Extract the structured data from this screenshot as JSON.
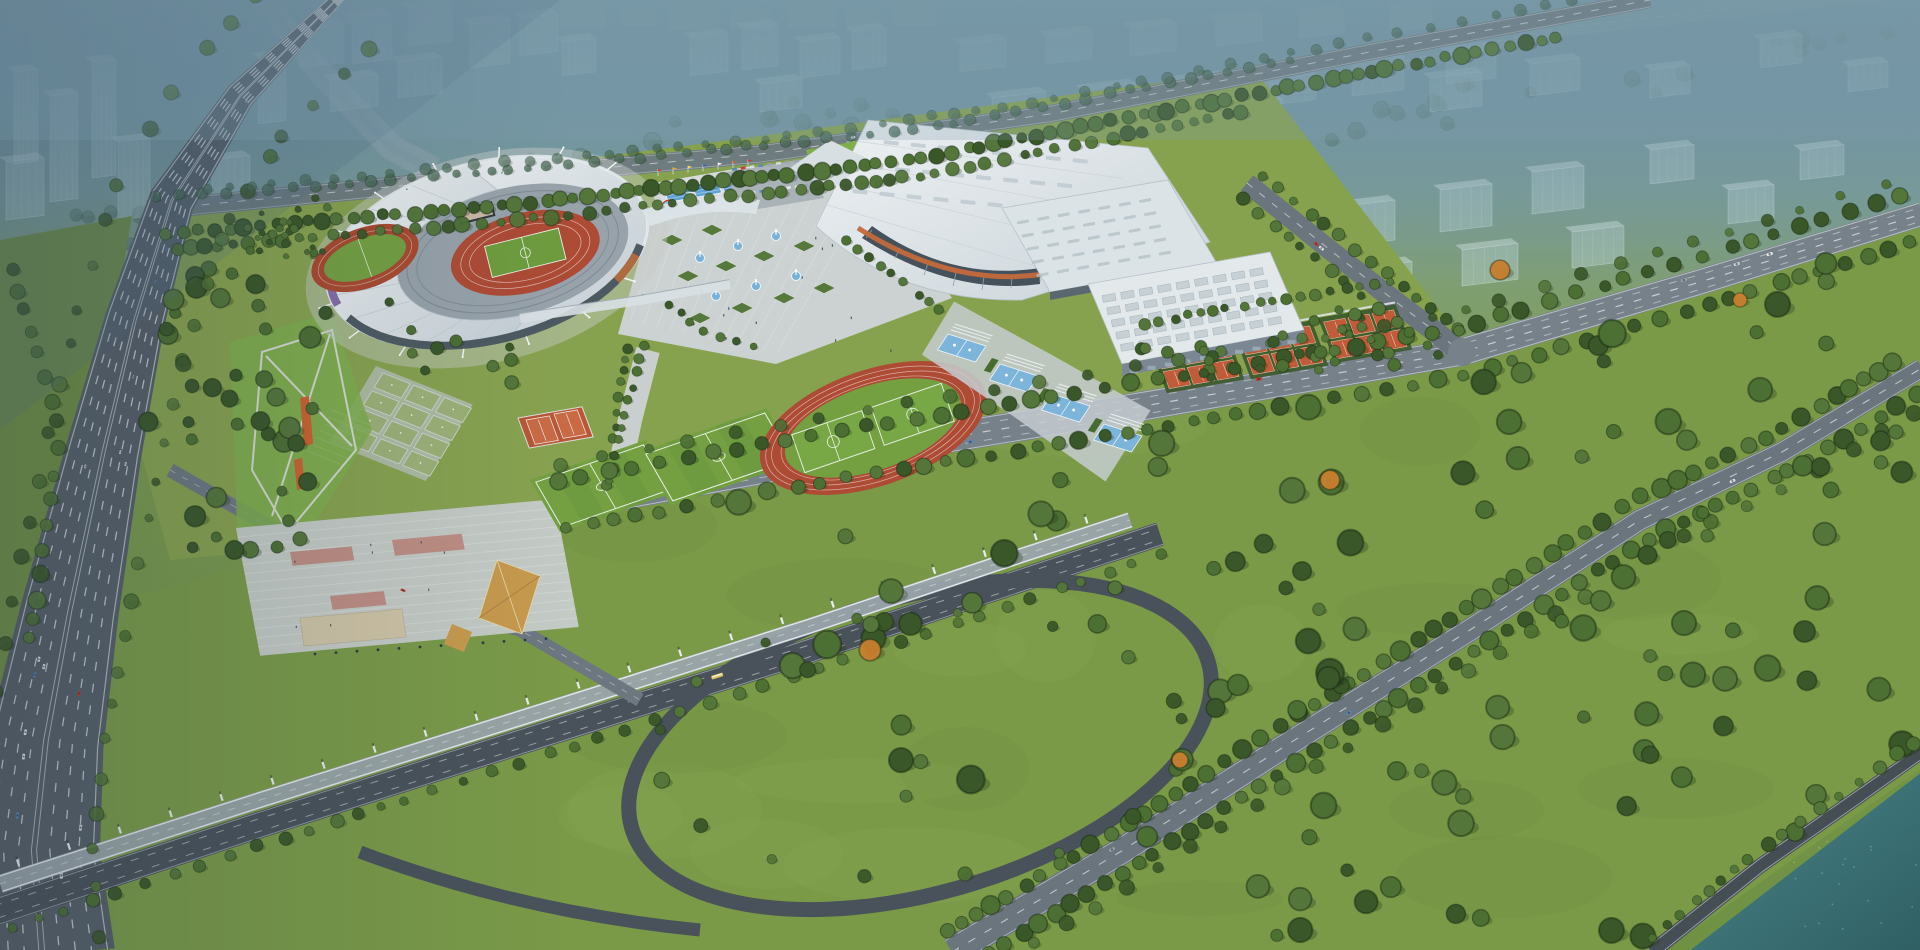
{
  "scene": {
    "description": "Aerial bird's-eye architectural rendering of a large sports-complex masterplan at hazy dusk: main stadium with white ring roof, exhibition arena, sports halls, outdoor courts and fields, central fountain plaza, highways and interchange, wooded riverside park",
    "type": "photorealistic CG aerial rendering"
  },
  "palette": {
    "haze_top": "#5f8494",
    "haze_mid": "#779a94",
    "ground_complex": "#87a24f",
    "ground_park": "#7a9a48",
    "ground_left": "#6f8d45",
    "lawn_bright": "#7fae4c",
    "pitch_green": "#74a042",
    "pitch_green_dark": "#699640",
    "tree_dark": "#3a5729",
    "tree_mid": "#4c6f33",
    "tree_light": "#54763a",
    "tree_far": "#4b6b58",
    "tree_autumn": "#c87f2e",
    "road": "#77818a",
    "road_mid": "#6b757d",
    "road_dark": "#49525a",
    "highway": "#565f68",
    "lane_marking": "#e9eef1",
    "roof_white": "#eef1f3",
    "roof_shadow": "#c3cdd4",
    "glass_dark": "#46525b",
    "facade_purple": "#7b5fa0",
    "facade_orange": "#bf6f3b",
    "track_red": "#ad4b35",
    "clay_court": "#c05c39",
    "clay_light": "#c96a45",
    "court_blue": "#7db4da",
    "pool_blue": "#5fa3d4",
    "plaza_paving": "#ccd2d1",
    "terrace_paving": "#c4cac5",
    "accent_pink": "#bd8277",
    "pavilion_gold": "#c79a4d",
    "beige_building": "#cfc4a6",
    "river": "#3f7478",
    "river_deep": "#2f5f63",
    "ghost_building": "#cfe2e8",
    "stands_grey": "#97a2aa",
    "car_red": "#c23b2e",
    "car_white": "#e8eaec",
    "car_grey": "#9aa5ad",
    "car_blue": "#5a86b8",
    "bus_yellow": "#e0c15a"
  },
  "landmarks": [
    {
      "name": "main-stadium",
      "label": "Main stadium with white ring roof and open bowl"
    },
    {
      "name": "practice-track",
      "label": "Warm-up running track"
    },
    {
      "name": "exhibition-arena",
      "label": "Exhibition arena with arched facade and orange stripe"
    },
    {
      "name": "sports-hall",
      "label": "Sports hall with skylight rows"
    },
    {
      "name": "training-hall",
      "label": "Training hall with grid skylights"
    },
    {
      "name": "central-plaza",
      "label": "Central plaza with fountains and diamond planters"
    },
    {
      "name": "outdoor-pools",
      "label": "Outdoor pools with flag row"
    },
    {
      "name": "cascade-pools",
      "label": "Terraced blue cascade pools"
    },
    {
      "name": "tennis-courts",
      "label": "Clay tennis court clusters"
    },
    {
      "name": "soccer-fields",
      "label": "Training soccer pitches"
    },
    {
      "name": "athletics-track",
      "label": "Athletics track with two infield pitches"
    },
    {
      "name": "gateball-courts",
      "label": "Grid of small game courts"
    },
    {
      "name": "event-lawn",
      "label": "Lawn with crossing paths and orange runways"
    },
    {
      "name": "terraced-plaza",
      "label": "Terraced entry plaza with gold pavilion"
    },
    {
      "name": "highway",
      "label": "Multi-lane expressway"
    },
    {
      "name": "interchange",
      "label": "Loop ramp interchange and elevated busway"
    },
    {
      "name": "arterial-road",
      "label": "Tree-lined arterial road"
    },
    {
      "name": "park",
      "label": "Wooded riverside park"
    },
    {
      "name": "river",
      "label": "River at the south-east corner"
    },
    {
      "name": "ghost-city",
      "label": "Translucent planned city blocks in haze"
    }
  ]
}
